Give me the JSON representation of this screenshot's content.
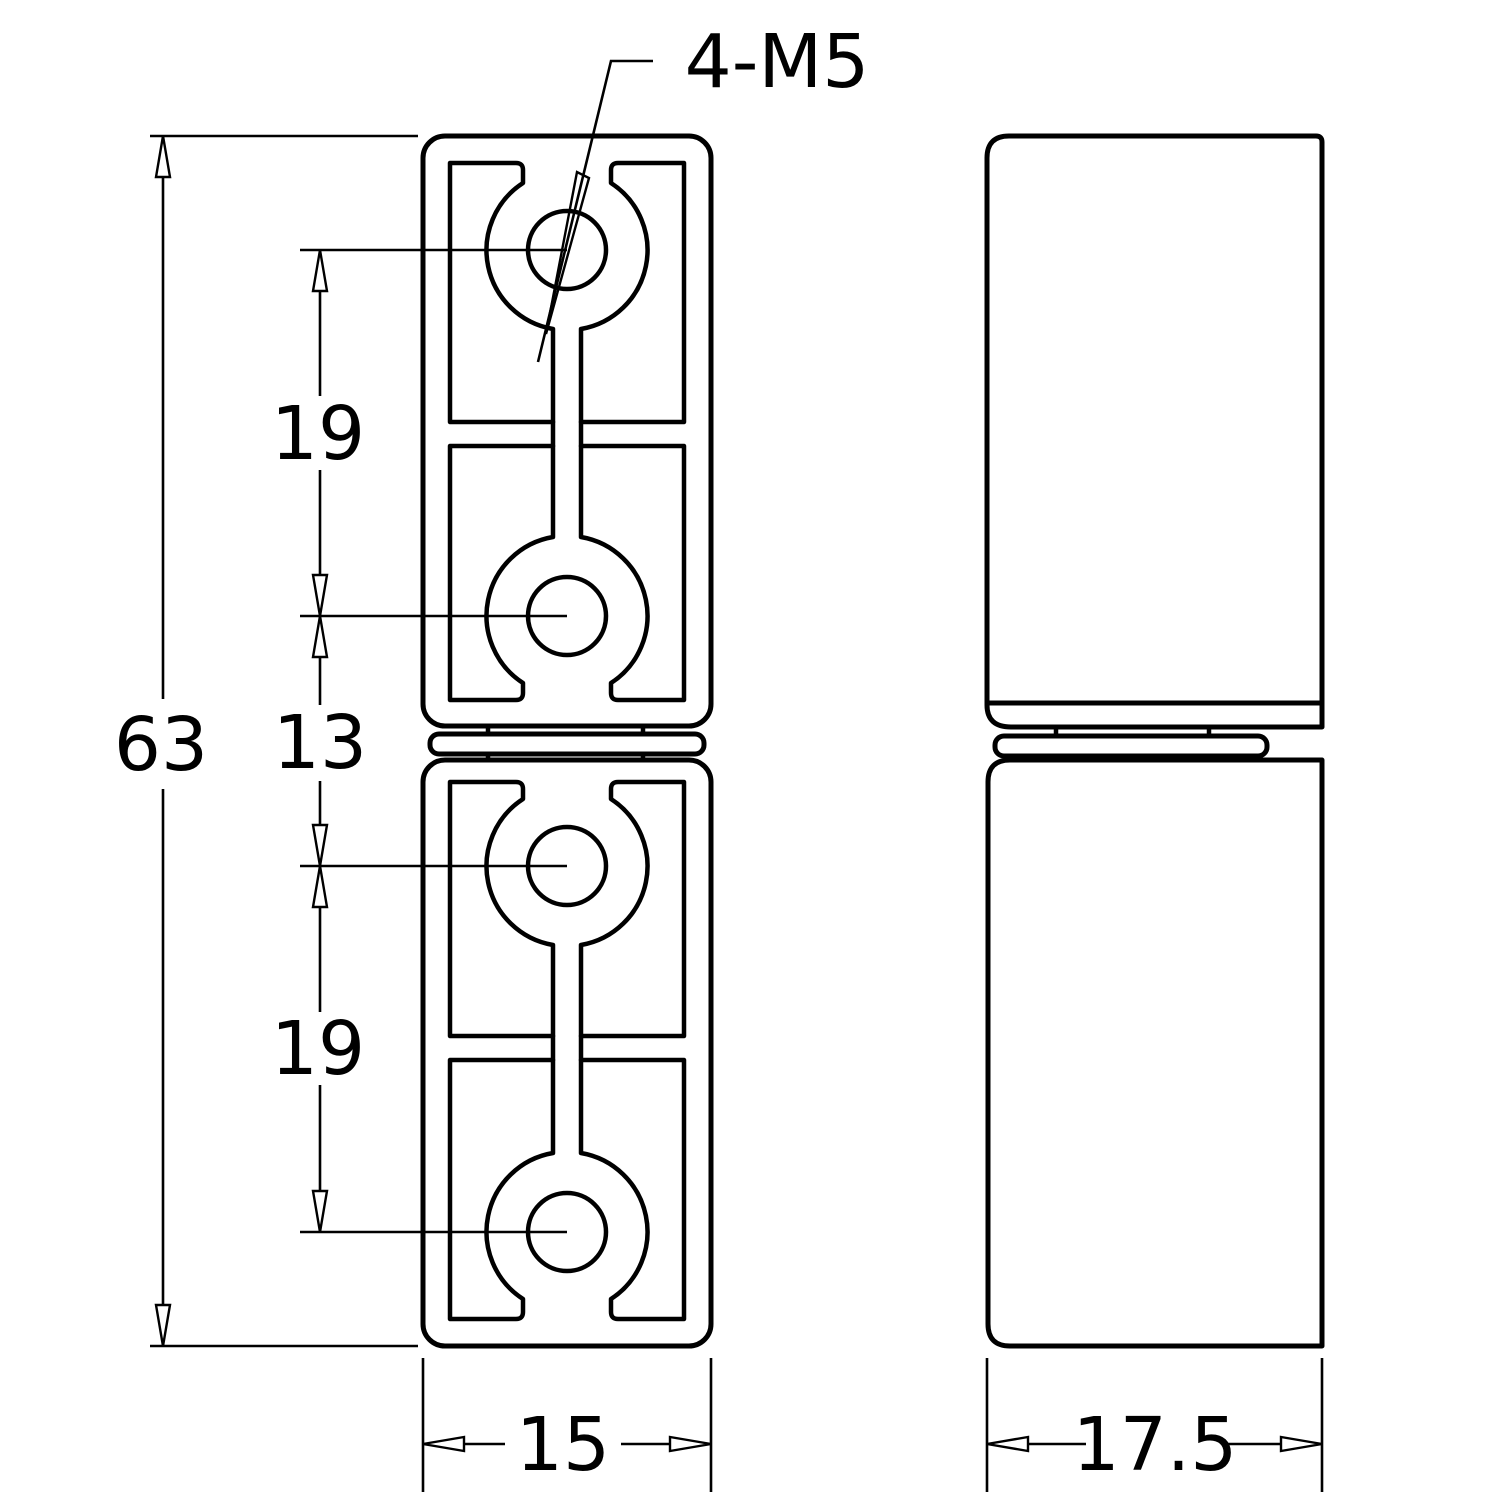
{
  "colors": {
    "paper": "#ffffff",
    "ink": "#000000"
  },
  "callout": {
    "thread_label": "4-M5"
  },
  "dimensions": {
    "overall_height": "63",
    "top_hole_pitch": "19",
    "middle_gap": "13",
    "bottom_hole_pitch": "19",
    "front_width": "15",
    "side_depth": "17.5"
  }
}
